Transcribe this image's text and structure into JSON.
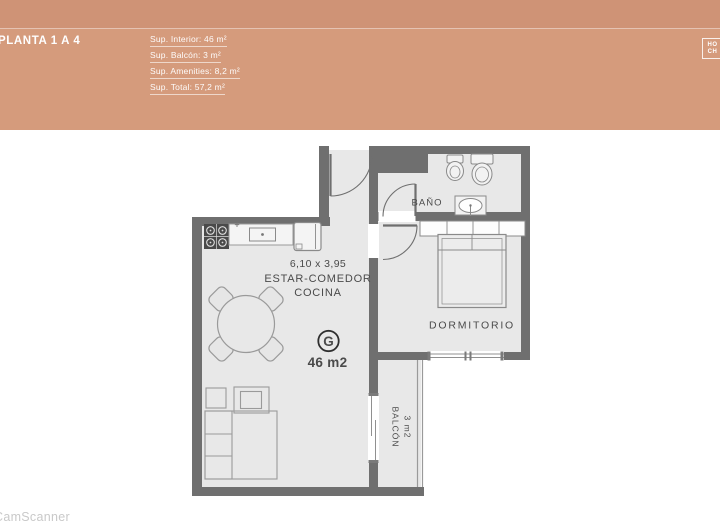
{
  "header": {
    "title": "PLANTA 1 A 4",
    "stats": [
      "Sup. Interior: 46 m²",
      "Sup. Balcón: 3 m²",
      "Sup. Amenities: 8,2 m²",
      "Sup. Total: 57,2 m²"
    ],
    "logo": {
      "line1": "HO",
      "line2": "CH"
    },
    "colors": {
      "banner": "#d59b7c",
      "banner_top": "#cf9376",
      "text": "#ffffff"
    }
  },
  "plan": {
    "labels": {
      "bathroom": "BAÑO",
      "bedroom": "DORMITORIO",
      "living_dimensions": "6,10 x 3,95",
      "living_line1": "ESTAR-COMEDOR",
      "living_line2": "COCINA",
      "unit_letter": "G",
      "unit_area": "46 m2",
      "balcony_name": "BALCÓN",
      "balcony_area": "3 m2"
    },
    "colors": {
      "wall": "#6f6f6f",
      "floor": "#e8e8e8",
      "furniture": "#9a9a9a",
      "label": "#4a4a4a"
    }
  },
  "watermark": "CamScanner"
}
